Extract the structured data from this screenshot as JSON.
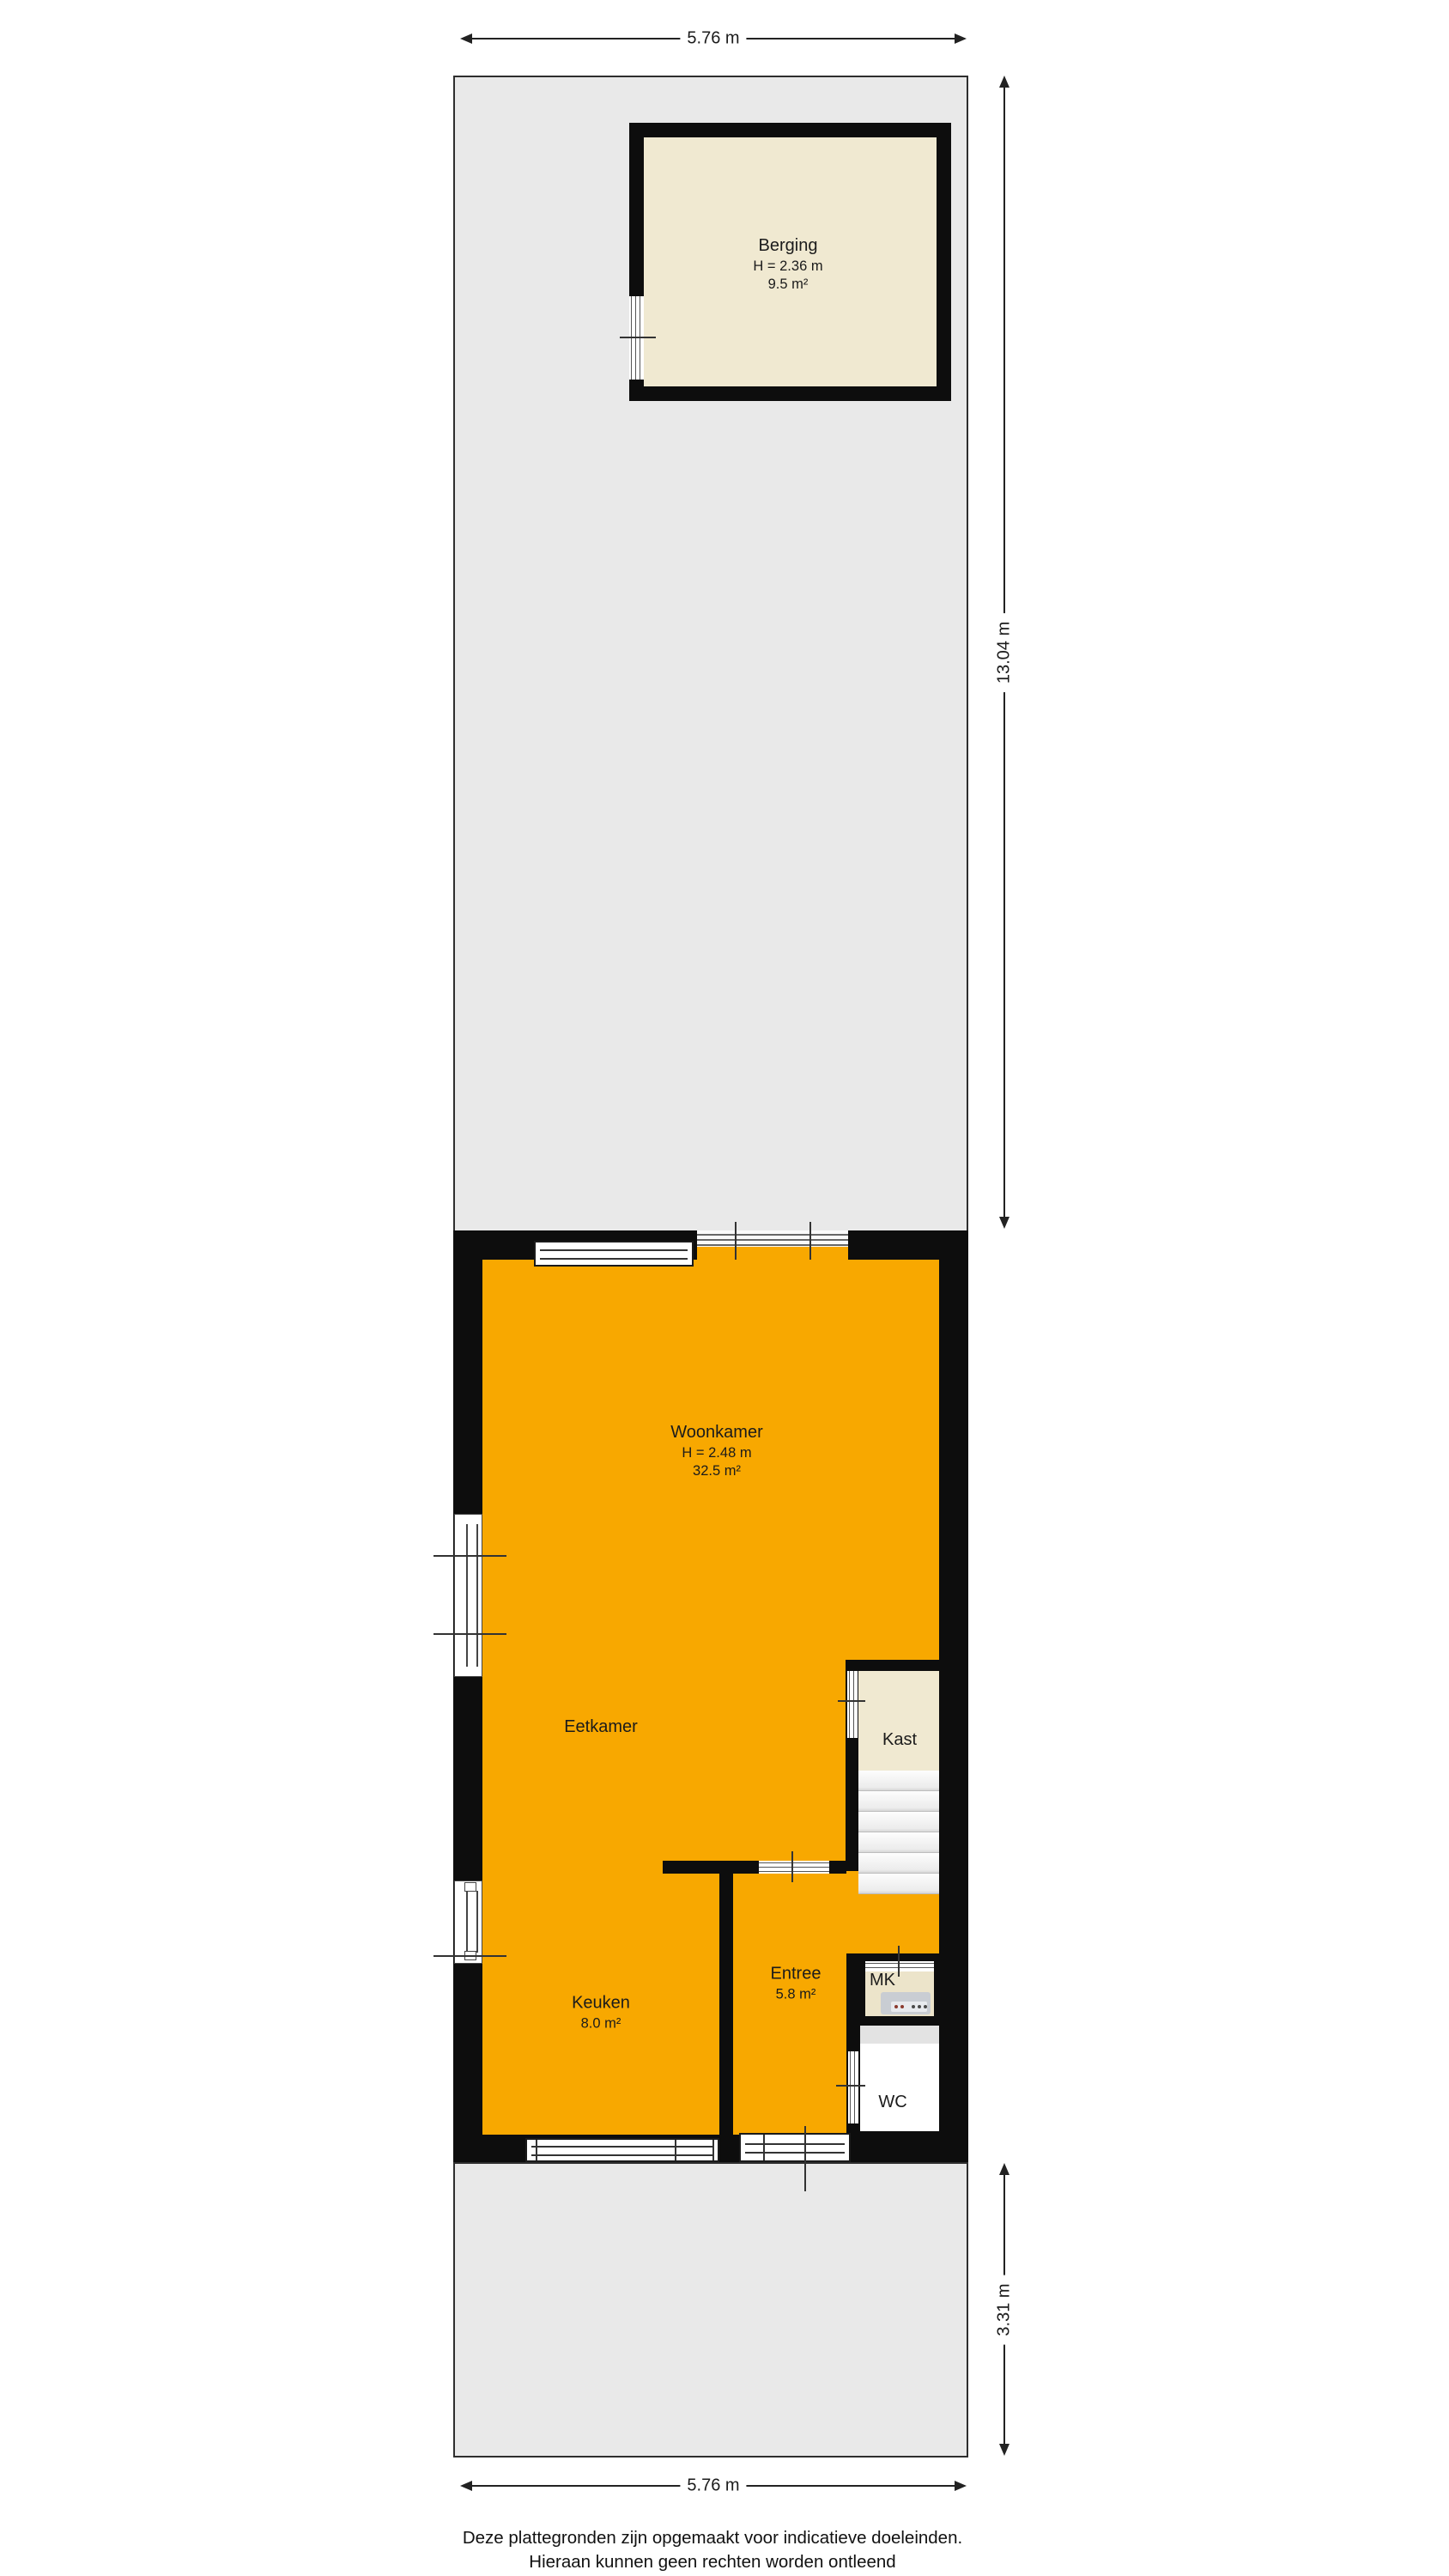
{
  "plan": {
    "type": "floorplan",
    "rooms": [
      {
        "id": "berging",
        "name": "Berging",
        "height": "H = 2.36 m",
        "area": "9.5 m²"
      },
      {
        "id": "woonkamer",
        "name": "Woonkamer",
        "height": "H = 2.48 m",
        "area": "32.5 m²"
      },
      {
        "id": "eetkamer",
        "name": "Eetkamer"
      },
      {
        "id": "kast",
        "name": "Kast"
      },
      {
        "id": "keuken",
        "name": "Keuken",
        "area": "8.0 m²"
      },
      {
        "id": "entree",
        "name": "Entree",
        "area": "5.8 m²"
      },
      {
        "id": "mk",
        "name": "MK"
      },
      {
        "id": "wc",
        "name": "WC"
      }
    ],
    "dimensions": {
      "width_top": "5.76 m",
      "depth_back_garden": "13.04 m",
      "depth_front_garden": "3.31 m",
      "width_bottom": "5.76 m"
    },
    "footer": {
      "line1": "Deze plattegronden zijn opgemaakt voor indicatieve doeleinden.",
      "line2": "Hieraan kunnen geen rechten worden ontleend"
    },
    "colors": {
      "floor_accent_orange": "#F8A800",
      "shed_and_closet_cream": "#F0E9D1",
      "garden_gray": "#E9E9E9",
      "wall_black": "#0D0D0D"
    }
  }
}
